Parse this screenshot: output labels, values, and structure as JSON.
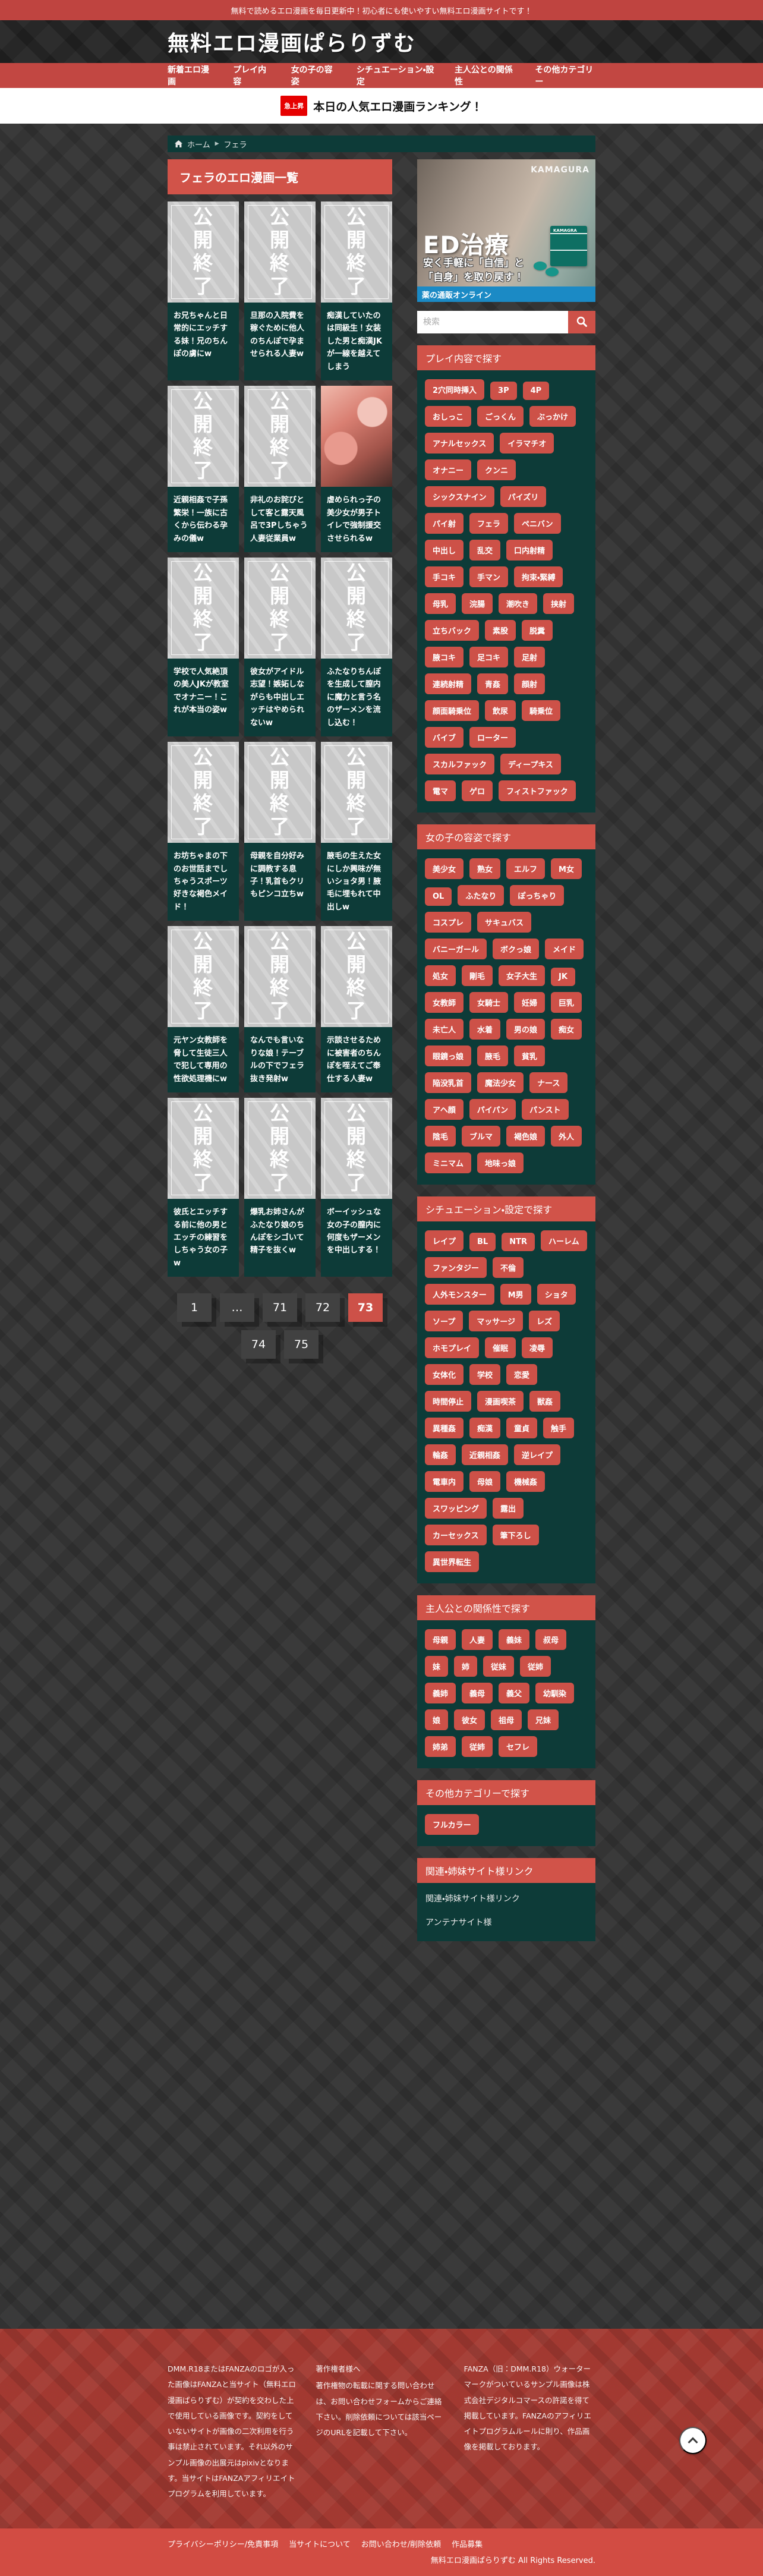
{
  "colors": {
    "accent_red": "#cd5148",
    "panel_teal": "#0d3b38",
    "banner_blue": "#1b8ac5",
    "footer_red": "#a23931",
    "footer_bottom_red": "#d24c43",
    "rank_badge_red": "#e60000"
  },
  "topbar": {
    "text": "無料で読めるエロ漫画を毎日更新中！初心者にも使いやすい無料エロ漫画サイトです！"
  },
  "header": {
    "site_title": "無料エロ漫画ぱらりずむ"
  },
  "nav": {
    "items": [
      "新着エロ漫画",
      "プレイ内容",
      "女の子の容姿",
      "シチュエーション・設定",
      "主人公との関係性",
      "その他カテゴリー"
    ]
  },
  "ranking_bar": {
    "badge": "急上昇",
    "text": "本日の人気エロ漫画ランキング！"
  },
  "breadcrumb": {
    "home": "ホーム",
    "current": "フェラ"
  },
  "main": {
    "heading": "フェラのエロ漫画一覧",
    "ended_label": "公開終了",
    "cards": [
      {
        "title": "お兄ちゃんと日常的にエッチする妹！兄のちんぽの虜にw",
        "thumb": "ended"
      },
      {
        "title": "旦那の入院費を稼ぐために他人のちんぽで孕ませられる人妻w",
        "thumb": "ended"
      },
      {
        "title": "痴漢していたのは同級生！女装した男と痴漢JKが一線を越えてしまう",
        "thumb": "ended"
      },
      {
        "title": "近親相姦で子孫繁栄！一族に古くから伝わる孕みの儀w",
        "thumb": "ended"
      },
      {
        "title": "非礼のお詫びとして客と露天風呂で3Pしちゃう人妻従業員w",
        "thumb": "ended"
      },
      {
        "title": "虐められっ子の美少女が男子トイレで強制援交させられるw",
        "thumb": "image"
      },
      {
        "title": "学校で人気絶頂の美人JKが教室でオナニー！これが本当の姿w",
        "thumb": "ended"
      },
      {
        "title": "彼女がアイドル志望！嫉妬しながらも中出しエッチはやめられないw",
        "thumb": "ended"
      },
      {
        "title": "ふたなりちんぽを生成して膣内に魔力と言う名のザーメンを流し込む！",
        "thumb": "ended"
      },
      {
        "title": "お坊ちゃまの下のお世話までしちゃうスポーツ好きな褐色メイド！",
        "thumb": "ended"
      },
      {
        "title": "母親を自分好みに調教する息子！乳首もクリもピンコ立ちw",
        "thumb": "ended"
      },
      {
        "title": "腋毛の生えた女にしか興味が無いショタ男！腋毛に埋もれて中出しw",
        "thumb": "ended"
      },
      {
        "title": "元ヤン女教師を脅して生徒三人で犯して専用の性欲処理機にw",
        "thumb": "ended"
      },
      {
        "title": "なんでも言いなりな娘！テーブルの下でフェラ抜き発射w",
        "thumb": "ended"
      },
      {
        "title": "示談させるために被害者のちんぽを咥えてご奉仕する人妻w",
        "thumb": "ended"
      },
      {
        "title": "彼氏とエッチする前に他の男とエッチの練習をしちゃう女の子w",
        "thumb": "ended"
      },
      {
        "title": "爆乳お姉さんがふたなり娘のちんぽをシゴいて精子を抜くw",
        "thumb": "ended"
      },
      {
        "title": "ボーイッシュな女の子の膣内に何度もザーメンを中出しする！",
        "thumb": "ended"
      }
    ],
    "pagination": {
      "items": [
        {
          "label": "1",
          "state": "page"
        },
        {
          "label": "…",
          "state": "dots"
        },
        {
          "label": "71",
          "state": "page"
        },
        {
          "label": "72",
          "state": "page"
        },
        {
          "label": "73",
          "state": "active"
        },
        {
          "label": "74",
          "state": "page"
        },
        {
          "label": "75",
          "state": "page"
        }
      ]
    }
  },
  "sidebar": {
    "ad": {
      "watermark": "KAMAGURA",
      "headline": "ED治療",
      "sub1": "安く手軽に「自信」と",
      "sub2": "「自身」を取り戻す！",
      "box_label": "KAMAGRA",
      "strip": "薬の通販オンライン"
    },
    "search": {
      "placeholder": "検索"
    },
    "sections": [
      {
        "title": "プレイ内容で探す",
        "tags": [
          "2穴同時挿入",
          "3P",
          "4P",
          "おしっこ",
          "ごっくん",
          "ぶっかけ",
          "アナルセックス",
          "イラマチオ",
          "オナニー",
          "クンニ",
          "シックスナイン",
          "パイズリ",
          "パイ射",
          "フェラ",
          "ペニバン",
          "中出し",
          "乱交",
          "口内射精",
          "手コキ",
          "手マン",
          "拘束・緊縛",
          "母乳",
          "浣腸",
          "潮吹き",
          "挟射",
          "立ちバック",
          "素股",
          "脱糞",
          "腋コキ",
          "足コキ",
          "足射",
          "連続射精",
          "青姦",
          "顔射",
          "顔面騎乗位",
          "飲尿",
          "騎乗位",
          "バイブ",
          "ローター",
          "スカルファック",
          "ディープキス",
          "電マ",
          "ゲロ",
          "フィストファック"
        ]
      },
      {
        "title": "女の子の容姿で探す",
        "tags": [
          "美少女",
          "熟女",
          "エルフ",
          "M女",
          "OL",
          "ふたなり",
          "ぽっちゃり",
          "コスプレ",
          "サキュバス",
          "バニーガール",
          "ボクっ娘",
          "メイド",
          "処女",
          "剛毛",
          "女子大生",
          "JK",
          "女教師",
          "女騎士",
          "妊婦",
          "巨乳",
          "未亡人",
          "水着",
          "男の娘",
          "痴女",
          "眼鏡っ娘",
          "腋毛",
          "貧乳",
          "陥没乳首",
          "魔法少女",
          "ナース",
          "アヘ顔",
          "パイパン",
          "パンスト",
          "陰毛",
          "ブルマ",
          "褐色娘",
          "外人",
          "ミニマム",
          "地味っ娘"
        ]
      },
      {
        "title": "シチュエーション・設定で探す",
        "tags": [
          "レイプ",
          "BL",
          "NTR",
          "ハーレム",
          "ファンタジー",
          "不倫",
          "人外モンスター",
          "M男",
          "ショタ",
          "ソープ",
          "マッサージ",
          "レズ",
          "ホモプレイ",
          "催眠",
          "凌辱",
          "女体化",
          "学校",
          "恋愛",
          "時間停止",
          "漫画喫茶",
          "獣姦",
          "異種姦",
          "痴漢",
          "童貞",
          "触手",
          "輪姦",
          "近親相姦",
          "逆レイプ",
          "電車内",
          "母娘",
          "機械姦",
          "スワッピング",
          "露出",
          "カーセックス",
          "筆下ろし",
          "異世界転生"
        ]
      },
      {
        "title": "主人公との関係性で探す",
        "tags": [
          "母親",
          "人妻",
          "義妹",
          "叔母",
          "妹",
          "姉",
          "従妹",
          "従姉",
          "義姉",
          "義母",
          "義父",
          "幼馴染",
          "娘",
          "彼女",
          "祖母",
          "兄妹",
          "姉弟",
          "従姉",
          "セフレ"
        ]
      },
      {
        "title": "その他カテゴリーで探す",
        "tags": [
          "フルカラー"
        ]
      }
    ],
    "links_section": {
      "title": "関連・姉妹サイト様リンク",
      "links": [
        "関連・姉妹サイト様リンク",
        "アンテナサイト様"
      ]
    }
  },
  "footer": {
    "col1": "DMM.R18またはFANZAのロゴが入った画像はFANZAと当サイト（無料エロ漫画ぱらりずむ）が契約を交わした上で使用している画像です。契約をしていないサイトが画像の二次利用を行う事は禁止されています。それ以外のサンプル画像の出展元はpixivとなります。当サイトはFANZAアフィリエイトプログラムを利用しています。",
    "col2_heading": "著作権者様へ",
    "col2": "著作権物の転載に関する問い合わせは、お問い合わせフォームからご連絡下さい。削除依頼については該当ページのURLを記載して下さい。",
    "col3": "FANZA（旧：DMM.R18）ウォーターマークがついているサンプル画像は株式会社デジタルコマースの許諾を得て掲載しています。FANZAのアフィリエイトプログラムルールに則り、作品画像を掲載しております。",
    "links": [
      "プライバシーポリシー/免責事項",
      "当サイトについて",
      "お問い合わせ/削除依頼",
      "作品募集"
    ],
    "copyright": "無料エロ漫画ぱらりずむ All Rights Reserved."
  }
}
